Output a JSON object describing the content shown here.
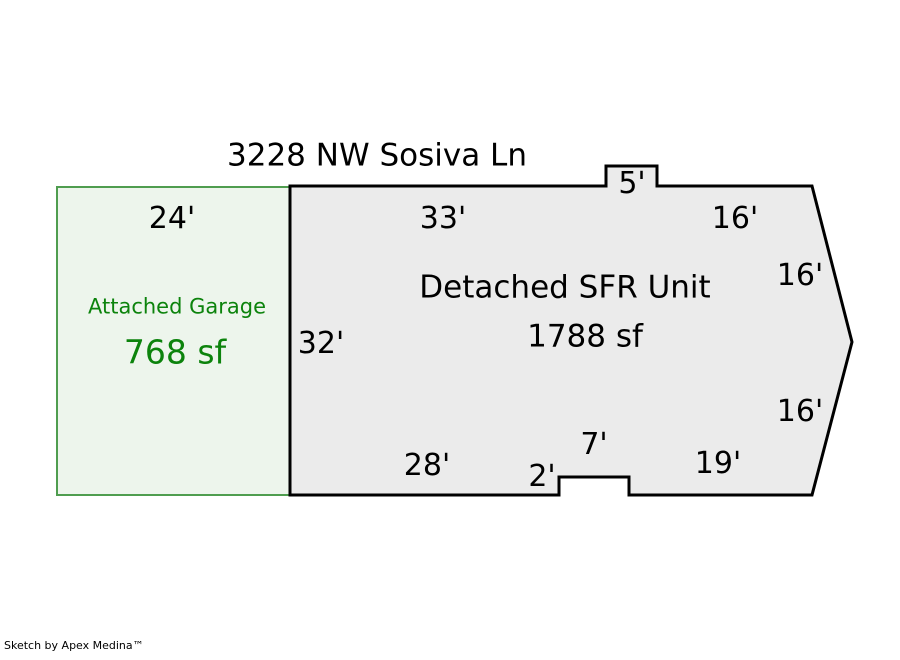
{
  "title": "3228 NW Sosiva Ln",
  "footer": "Sketch by Apex Medina™",
  "garage": {
    "name": "Attached Garage",
    "area": "768 sf",
    "dims": {
      "top": "24'"
    }
  },
  "unit": {
    "name": "Detached SFR Unit",
    "area": "1788 sf",
    "dims": {
      "top": "33'",
      "bump": "5'",
      "top_right": "16'",
      "upper_right": "16'",
      "lower_right": "16'",
      "left": "32'",
      "bottom": "28'",
      "notch_height": "2'",
      "notch_width": "7'",
      "bottom_right": "19'"
    }
  },
  "colors": {
    "garage_fill": "#edf5ec",
    "garage_border": "#4f9d4f",
    "garage_text": "#0c830c",
    "unit_fill": "#ebebeb",
    "unit_border": "#000000",
    "label_text": "#000000",
    "page_background": "#ffffff"
  }
}
